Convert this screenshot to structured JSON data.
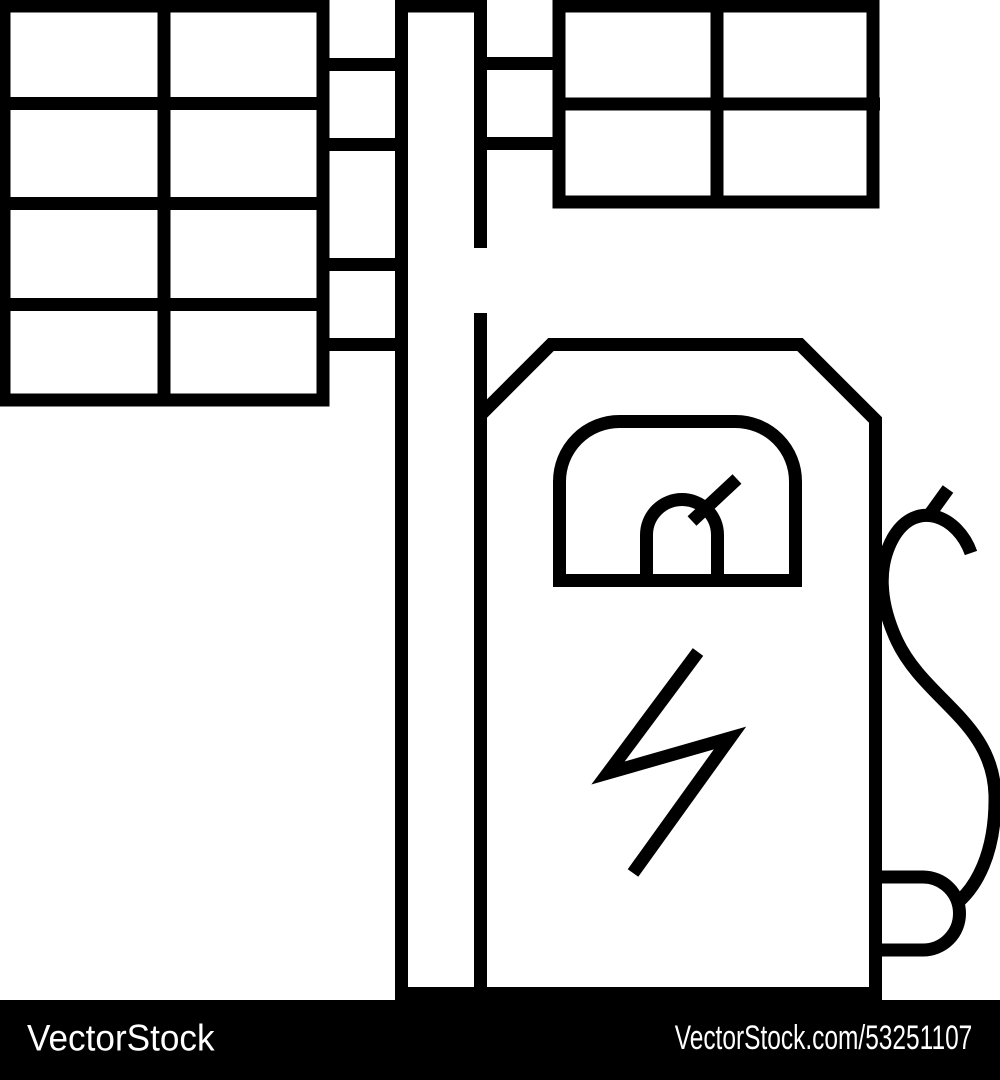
{
  "page": {
    "background_color": "#ffffff"
  },
  "icon": {
    "name": "solar-powered-ev-charging-station-line-icon",
    "stroke_color": "#000000",
    "fill_color": "none",
    "parts": [
      "solar-panel-left",
      "solar-panel-left-connector",
      "utility-pole",
      "solar-panel-right",
      "solar-panel-right-connector",
      "ev-charger-body",
      "charger-display",
      "gauge-icon",
      "gauge-needle",
      "lightning-bolt-icon",
      "cable-handle",
      "charging-cable",
      "cable-holster",
      "ground-line"
    ]
  },
  "footer": {
    "background_color": "#000000",
    "text_color": "#ffffff",
    "brand": "VectorStock",
    "image_url_label": "VectorStock.com/53251107"
  }
}
